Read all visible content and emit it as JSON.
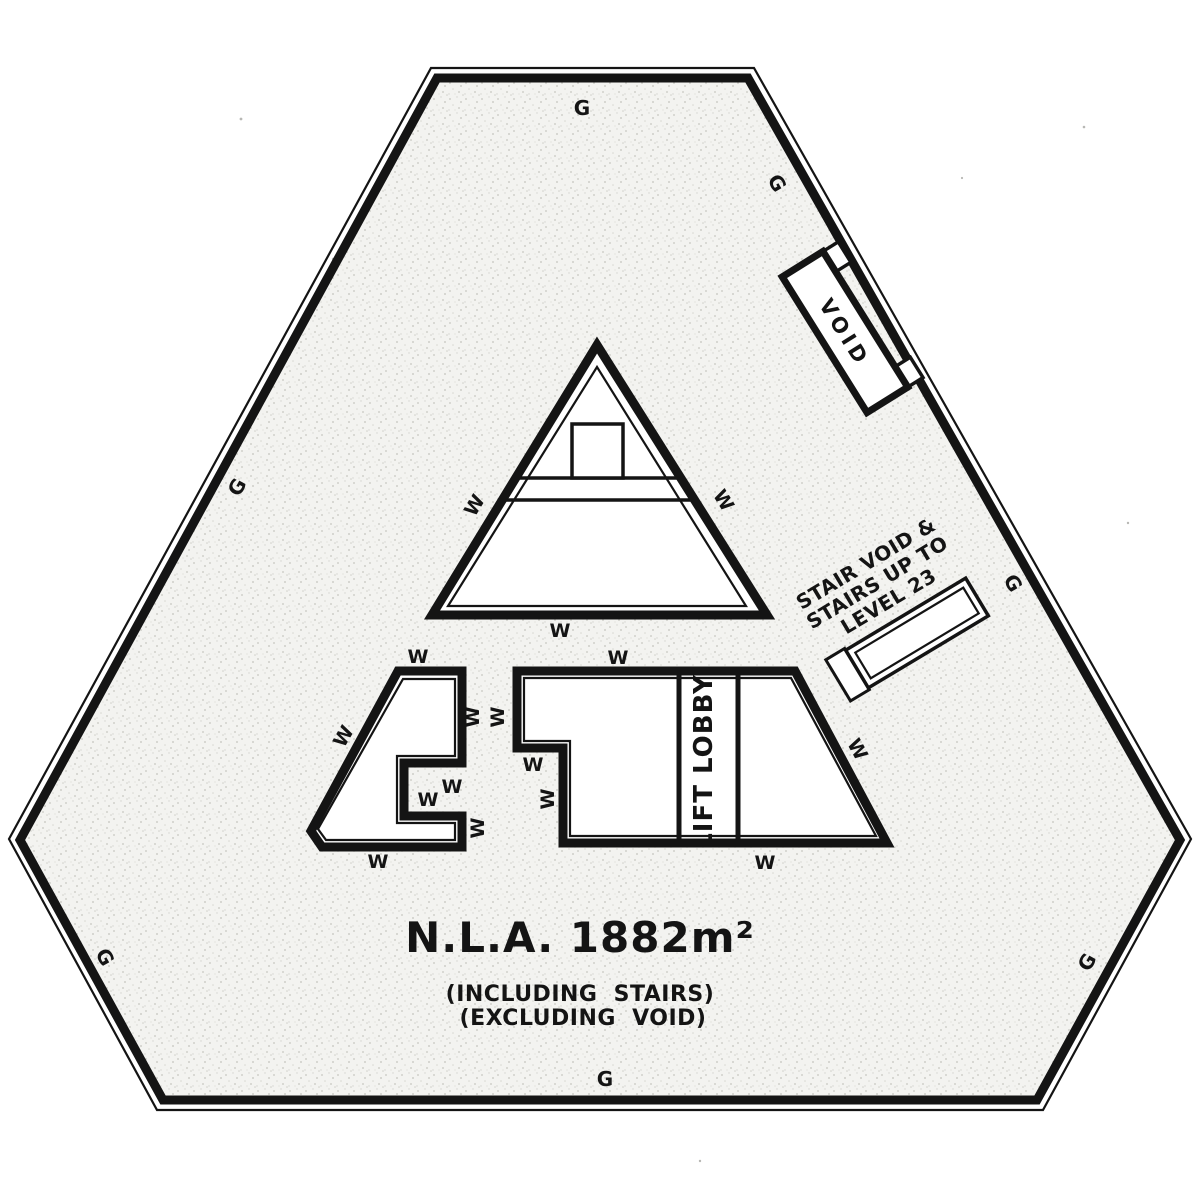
{
  "plan": {
    "area_summary": {
      "title": "N.L.A. 1882m²",
      "note1": "(INCLUDING STAIRS)",
      "note2": "(EXCLUDING VOID)"
    },
    "rooms": {
      "lift_lobby": "LIFT LOBBY",
      "void": "VOID"
    },
    "stair_note": {
      "line1": "STAIR VOID &",
      "line2": "STAIRS UP TO",
      "line3": "LEVEL 23"
    },
    "labels": {
      "glazing": "G",
      "wall": "W"
    },
    "colors": {
      "ink": "#141414",
      "floor": "#f3f3f0",
      "paper": "#ffffff"
    }
  }
}
